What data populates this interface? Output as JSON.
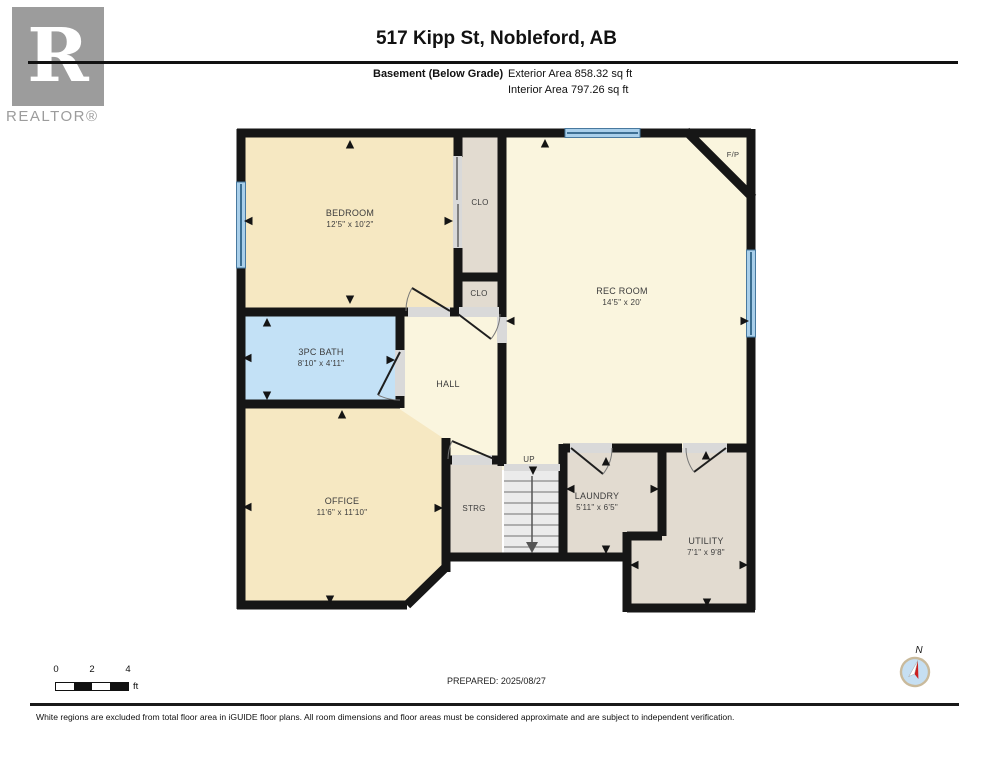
{
  "header": {
    "logo_letter": "R",
    "brand": "REALTOR®",
    "title": "517 Kipp St, Nobleford, AB",
    "floor_label": "Basement (Below Grade)",
    "exterior_area": "Exterior Area 858.32 sq ft",
    "interior_area": "Interior Area 797.26 sq ft"
  },
  "plan": {
    "rooms": {
      "bedroom": {
        "name": "BEDROOM",
        "dims": "12'5\" x 10'2\""
      },
      "closet_top": {
        "name": "CLO"
      },
      "closet_mid": {
        "name": "CLO"
      },
      "rec_room": {
        "name": "REC ROOM",
        "dims": "14'5\" x 20'"
      },
      "fireplace": {
        "name": "F/P"
      },
      "bath": {
        "name": "3PC BATH",
        "dims": "8'10\" x 4'11\""
      },
      "hall": {
        "name": "HALL"
      },
      "office": {
        "name": "OFFICE",
        "dims": "11'6\" x 11'10\""
      },
      "storage": {
        "name": "STRG"
      },
      "stairs_up": {
        "name": "UP"
      },
      "laundry": {
        "name": "LAUNDRY",
        "dims": "5'11\" x 6'5\""
      },
      "utility": {
        "name": "UTILITY",
        "dims": "7'1\" x 9'8\""
      }
    },
    "colors": {
      "wall": "#161616",
      "tan": "#F6E8C2",
      "cream": "#FAF5DE",
      "taupe": "#E2DBD0",
      "bath_blue": "#C3E1F6",
      "window_blue": "#A9CFEA",
      "stairs_gray": "#EBEBEB",
      "threshold_gray": "#D9D9D9"
    }
  },
  "footer": {
    "scale": {
      "tick0": "0",
      "tick2": "2",
      "tick4": "4",
      "unit": "ft"
    },
    "prepared": "PREPARED: 2025/08/27",
    "compass_label": "N",
    "disclaimer": "White regions are excluded from total floor area in iGUIDE floor plans. All room dimensions and floor areas must be considered approximate and are subject to independent verification."
  }
}
